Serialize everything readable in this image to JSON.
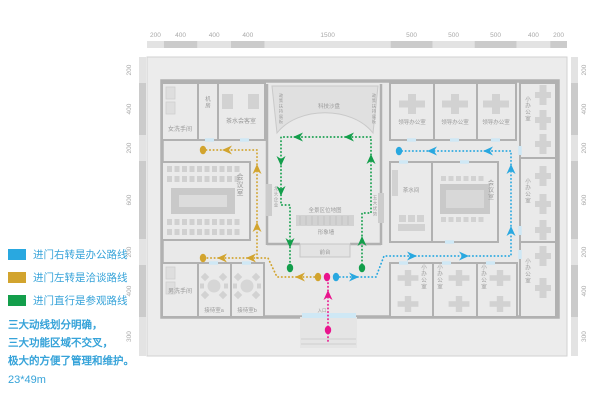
{
  "legend": {
    "items": [
      {
        "name": "office-route",
        "color": "#29a8e0",
        "label": "进门右转是办公路线"
      },
      {
        "name": "negotiation-route",
        "color": "#d2a42e",
        "label": "进门左转是洽谈路线"
      },
      {
        "name": "tour-route",
        "color": "#139e4b",
        "label": "进门直行是参观路线"
      }
    ],
    "notes": [
      "三大动线划分明确，",
      "三大功能区域不交叉，",
      "极大的方便了管理和维护。"
    ],
    "size_label": "23*49m"
  },
  "dimensions": {
    "top": [
      "200",
      "400",
      "400",
      "400",
      "1500",
      "500",
      "500",
      "500",
      "400",
      "200"
    ],
    "left": [
      "200",
      "400",
      "200",
      "600",
      "200",
      "400",
      "300"
    ],
    "right": [
      "200",
      "400",
      "200",
      "600",
      "200",
      "400",
      "300"
    ]
  },
  "rooms": [
    {
      "id": "women_wc",
      "label": "女洗手间"
    },
    {
      "id": "server_room",
      "label": "机房"
    },
    {
      "id": "tea_guest",
      "label": "茶水会客室"
    },
    {
      "id": "meeting_left",
      "label": "会议室"
    },
    {
      "id": "men_wc",
      "label": "男洗手间"
    },
    {
      "id": "reception_a",
      "label": "接待室a"
    },
    {
      "id": "reception_b",
      "label": "接待室b"
    },
    {
      "id": "leader_1",
      "label": "领导办公室"
    },
    {
      "id": "leader_2",
      "label": "领导办公室"
    },
    {
      "id": "leader_3",
      "label": "领导办公室"
    },
    {
      "id": "tea_room",
      "label": "茶水间"
    },
    {
      "id": "meeting_right",
      "label": "会议室"
    },
    {
      "id": "small_right_top",
      "label": "小办公室"
    },
    {
      "id": "small_right_mid",
      "label": "小办公室"
    },
    {
      "id": "small_right_bottom",
      "label": "小办公室"
    },
    {
      "id": "small_bottom_1",
      "label": "小办公室"
    },
    {
      "id": "small_bottom_2",
      "label": "小办公室"
    },
    {
      "id": "small_bottom_3",
      "label": "小办公室"
    }
  ],
  "hall_labels": [
    {
      "id": "tech_sandbox",
      "label": "科技沙盘"
    },
    {
      "id": "policy_left",
      "label": "政策扶持展板"
    },
    {
      "id": "policy_right",
      "label": "政策扶持展板"
    },
    {
      "id": "leading_companies",
      "label": "龙头企业"
    },
    {
      "id": "location_map",
      "label": "全景区位地图"
    },
    {
      "id": "image_wall",
      "label": "形象墙"
    },
    {
      "id": "front_desk",
      "label": "前台"
    },
    {
      "id": "five_advantages",
      "label": "五大优势"
    },
    {
      "id": "entrance",
      "label": "入口"
    }
  ],
  "routes": {
    "office": {
      "color": "#29a8e0"
    },
    "negotiation": {
      "color": "#d2a42e"
    },
    "tour": {
      "color": "#139e4b"
    },
    "entry": {
      "color": "#e9148d"
    }
  },
  "colors": {
    "plan_bg": "#ececec",
    "building_bg": "#e9e9e9",
    "wall": "#b1b1b1",
    "furniture": "#d2d2d2",
    "door": "#cfe8f5",
    "ruler_light": "#e3e3e3",
    "ruler_dark": "#cbcbcb",
    "dim_text": "#a8a8a8",
    "room_text": "#9a9a9a"
  }
}
